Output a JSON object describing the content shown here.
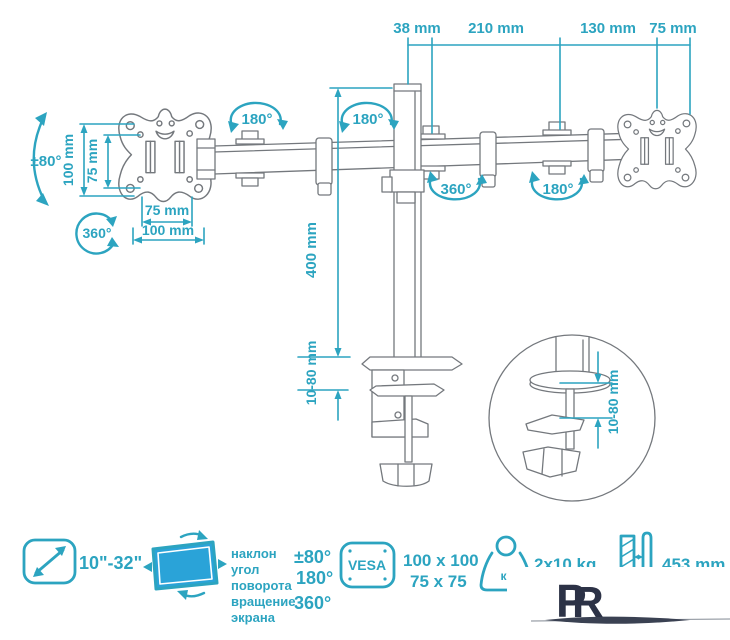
{
  "colors": {
    "teal": "#2ca4c0",
    "line_gray": "#74787d",
    "screen_blue": "#2aa3d8",
    "logo_navy": "#2c3246"
  },
  "top_dimensions": {
    "labels": [
      "38 mm",
      "210 mm",
      "130 mm",
      "75 mm"
    ]
  },
  "plate_dimensions": {
    "vertical_100": "100 mm",
    "vertical_75": "75 mm",
    "horizontal_75": "75 mm",
    "horizontal_100": "100 mm"
  },
  "angles": {
    "tilt_range": "±80°",
    "swivel_circle": "360°",
    "arm_rotation_1": "180°",
    "arm_rotation_2": "180°",
    "arm_rotation_3": "360°",
    "arm_rotation_4": "180°"
  },
  "pole": {
    "height": "400 mm",
    "clamp_range": "10-80 mm"
  },
  "detail_view": {
    "clamp_range": "10-80 mm"
  },
  "features": {
    "screen_size": "10\"-32\"",
    "adjust_lines": [
      "наклон",
      "угол",
      "поворота",
      "вращение",
      "экрана"
    ],
    "adjust_values": [
      "±80°",
      "180°",
      "360°"
    ],
    "vesa_label": "VESA",
    "vesa_sizes": [
      "100 x 100",
      "75 x 75"
    ],
    "weight_unit": "кг",
    "max_weight": "2x10 kg",
    "pole_height": "453 mm"
  },
  "watermark": {
    "letter_p": "P",
    "letter_r": "R"
  }
}
